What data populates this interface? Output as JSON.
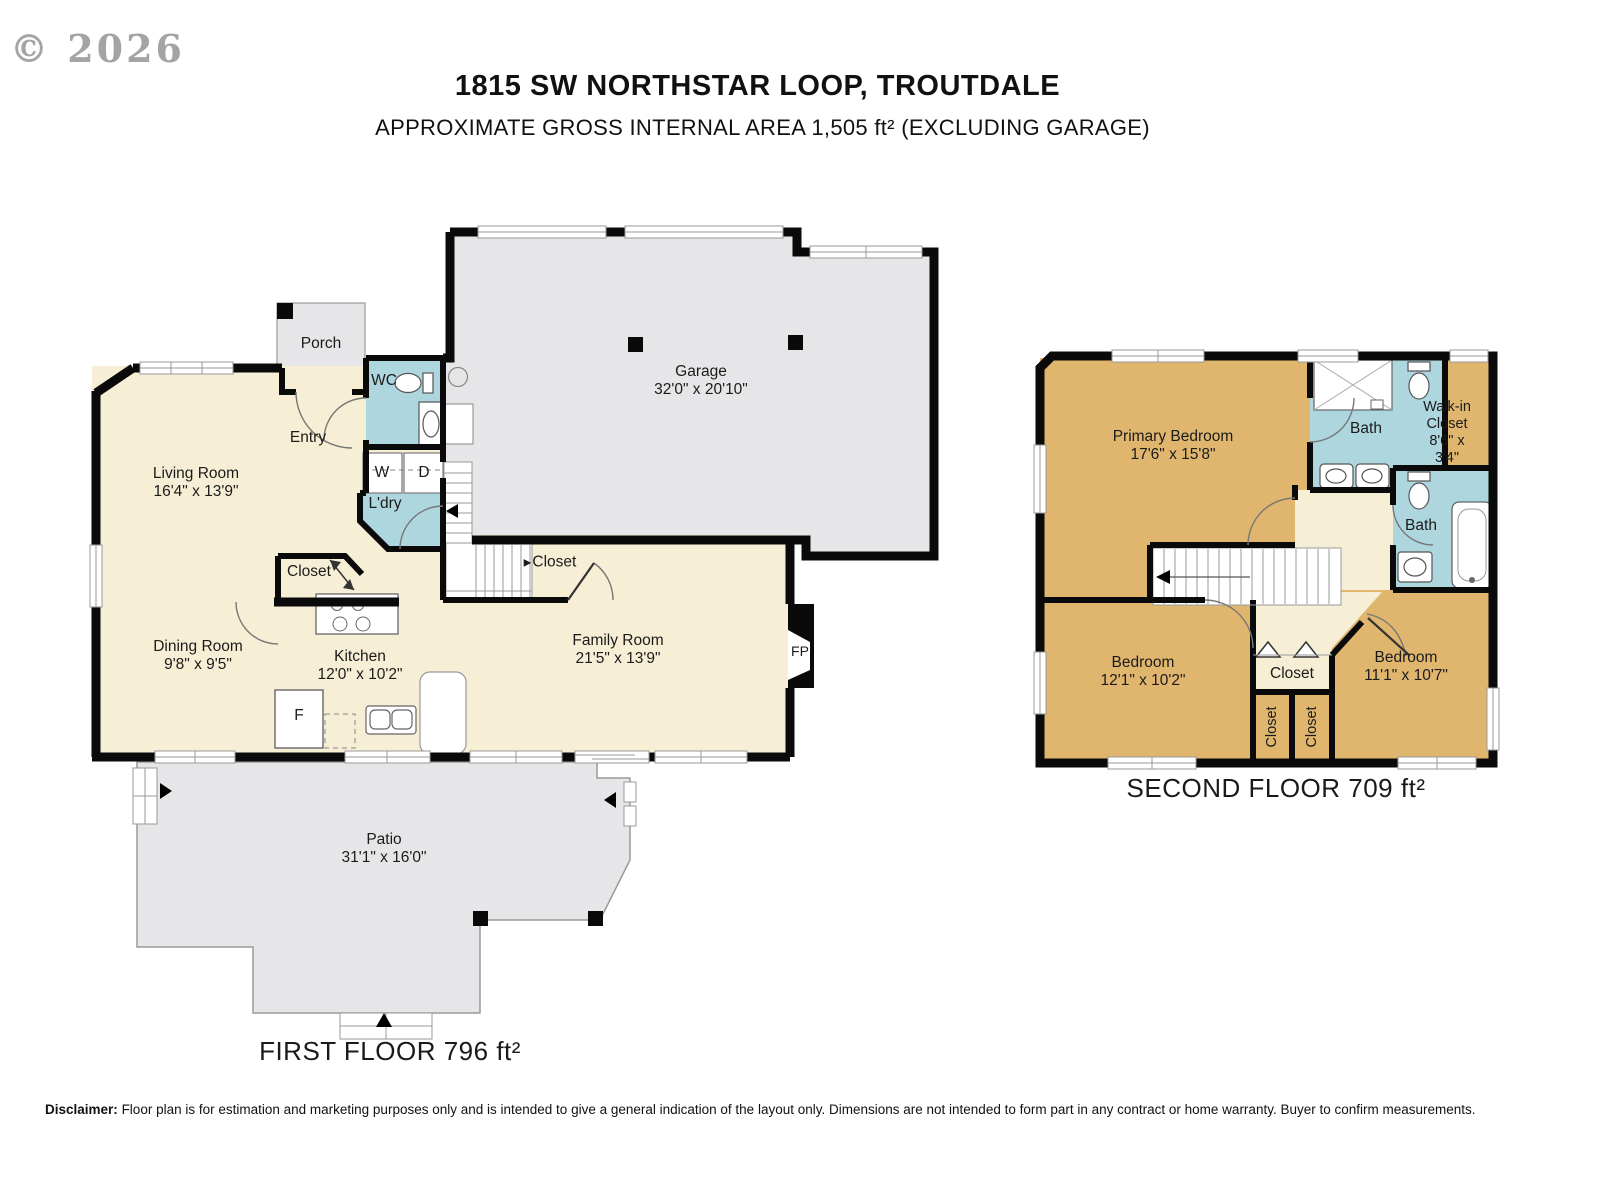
{
  "watermark": "© 2026",
  "header": {
    "title": "1815 SW NORTHSTAR LOOP, TROUTDALE",
    "subtitle": "APPROXIMATE GROSS INTERNAL AREA 1,505 ft² (EXCLUDING GARAGE)"
  },
  "icons": {
    "right_arrow": "▶",
    "left_arrow": "◀",
    "up_arrow": "▲"
  },
  "colors": {
    "room_cream": "#f6eed5",
    "wet_room_blue": "#aed6df",
    "outdoor_gray": "#e6e6e8",
    "bedroom_tan": "#e0b66e",
    "wall_black": "#0a0a0a"
  },
  "floor1": {
    "area_label": "FIRST FLOOR 796 ft²",
    "rooms": {
      "porch": {
        "name": "Porch"
      },
      "wc": {
        "name": "WC"
      },
      "entry": {
        "name": "Entry"
      },
      "living": {
        "name": "Living Room",
        "dims": "16'4\" x 13'9\""
      },
      "washer": {
        "name": "W"
      },
      "dryer": {
        "name": "D"
      },
      "laundry": {
        "name": "L'dry"
      },
      "garage": {
        "name": "Garage",
        "dims": "32'0\" x 20'10\""
      },
      "closet_hall": {
        "name": "Closet"
      },
      "closet_stairs": {
        "name": "Closet"
      },
      "dining": {
        "name": "Dining Room",
        "dims": "9'8\" x 9'5\""
      },
      "kitchen": {
        "name": "Kitchen",
        "dims": "12'0\" x 10'2\""
      },
      "fridge": {
        "name": "F"
      },
      "family": {
        "name": "Family Room",
        "dims": "21'5\" x 13'9\""
      },
      "fireplace": {
        "name": "FP"
      },
      "patio": {
        "name": "Patio",
        "dims": "31'1\" x 16'0\""
      }
    }
  },
  "floor2": {
    "area_label": "SECOND FLOOR 709 ft²",
    "rooms": {
      "primary": {
        "name": "Primary Bedroom",
        "dims": "17'6\" x 15'8\""
      },
      "bath_top": {
        "name": "Bath"
      },
      "walkin": {
        "name": "Walk-in Closet",
        "dims": "8'6\" x 3'4\""
      },
      "bath_right": {
        "name": "Bath"
      },
      "bedroom_left": {
        "name": "Bedroom",
        "dims": "12'1\" x 10'2\""
      },
      "closet_hall": {
        "name": "Closet"
      },
      "closet_left": {
        "name": "Closet"
      },
      "closet_right": {
        "name": "Closet"
      },
      "bedroom_right": {
        "name": "Bedroom",
        "dims": "11'1\" x 10'7\""
      }
    }
  },
  "disclaimer": {
    "label": "Disclaimer:",
    "text": "Floor plan is for estimation and marketing purposes only and is intended to give a general indication of the layout only. Dimensions are not intended to form part in any contract or home warranty. Buyer to confirm measurements."
  }
}
